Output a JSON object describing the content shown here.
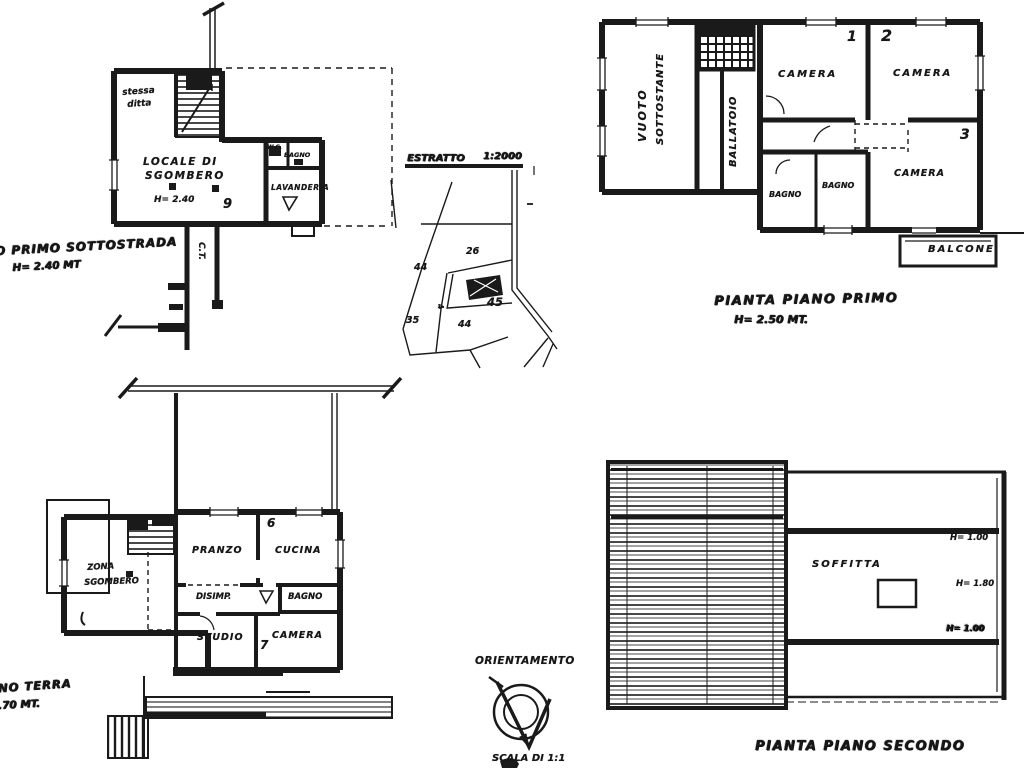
{
  "page": {
    "background": "#ffffff",
    "ink": "#1a1a1a"
  },
  "plans": {
    "sottostrada": {
      "caption": [
        "PIANO PRIMO SOTTOSTRADA",
        "H= 2.40 MT"
      ],
      "rooms": {
        "stessa_ditta": [
          "stessa",
          "ditta"
        ],
        "locale": [
          "LOCALE DI",
          "SGOMBERO"
        ],
        "locale_height": "H= 2.40",
        "wc": "W.C.",
        "bagno": "BAGNO",
        "lavanderia": "LAVANDERIA",
        "ct": "C.T."
      },
      "number": "9"
    },
    "primo": {
      "caption": [
        "PIANTA PIANO PRIMO",
        "H= 2.50 MT."
      ],
      "rooms": {
        "vuoto": [
          "VUOTO",
          "SOTTOSTANTE"
        ],
        "ballatoio": "BALLATOIO",
        "camera1": "CAMERA",
        "camera2": "CAMERA",
        "camera3": "CAMERA",
        "bagno1": "BAGNO",
        "bagno2": "BAGNO",
        "balcone": "BALCONE"
      },
      "numbers": {
        "n1": "1",
        "n2": "2",
        "n3": "3"
      }
    },
    "terra": {
      "caption": [
        "PIANO TERRA",
        "H 2.70 MT."
      ],
      "rooms": {
        "zona": [
          "ZONA",
          "SGOMBERO"
        ],
        "pranzo": "PRANZO",
        "cucina": "CUCINA",
        "disimp": "DISIMP.",
        "bagno": "BAGNO",
        "studio": "STUDIO",
        "camera": "CAMERA"
      },
      "numbers": {
        "n6": "6",
        "n7": "7"
      }
    },
    "secondo": {
      "caption": "PIANTA PIANO SECONDO",
      "rooms": {
        "soffitta": "SOFFITTA"
      },
      "heights": {
        "top": "H= 1.00",
        "mid": "H= 1.80",
        "bottom": "H= 1.00"
      }
    }
  },
  "site_map": {
    "title_word": "ESTRATTO",
    "title_scale": "1:2000",
    "parcels": {
      "p26": "26",
      "p44_left": "44",
      "p45": "45",
      "p44_bottom": "44",
      "p35": "35",
      "p4": "4"
    }
  },
  "compass": {
    "title": "ORIENTAMENTO",
    "scale": "SCALA DI 1:1"
  }
}
